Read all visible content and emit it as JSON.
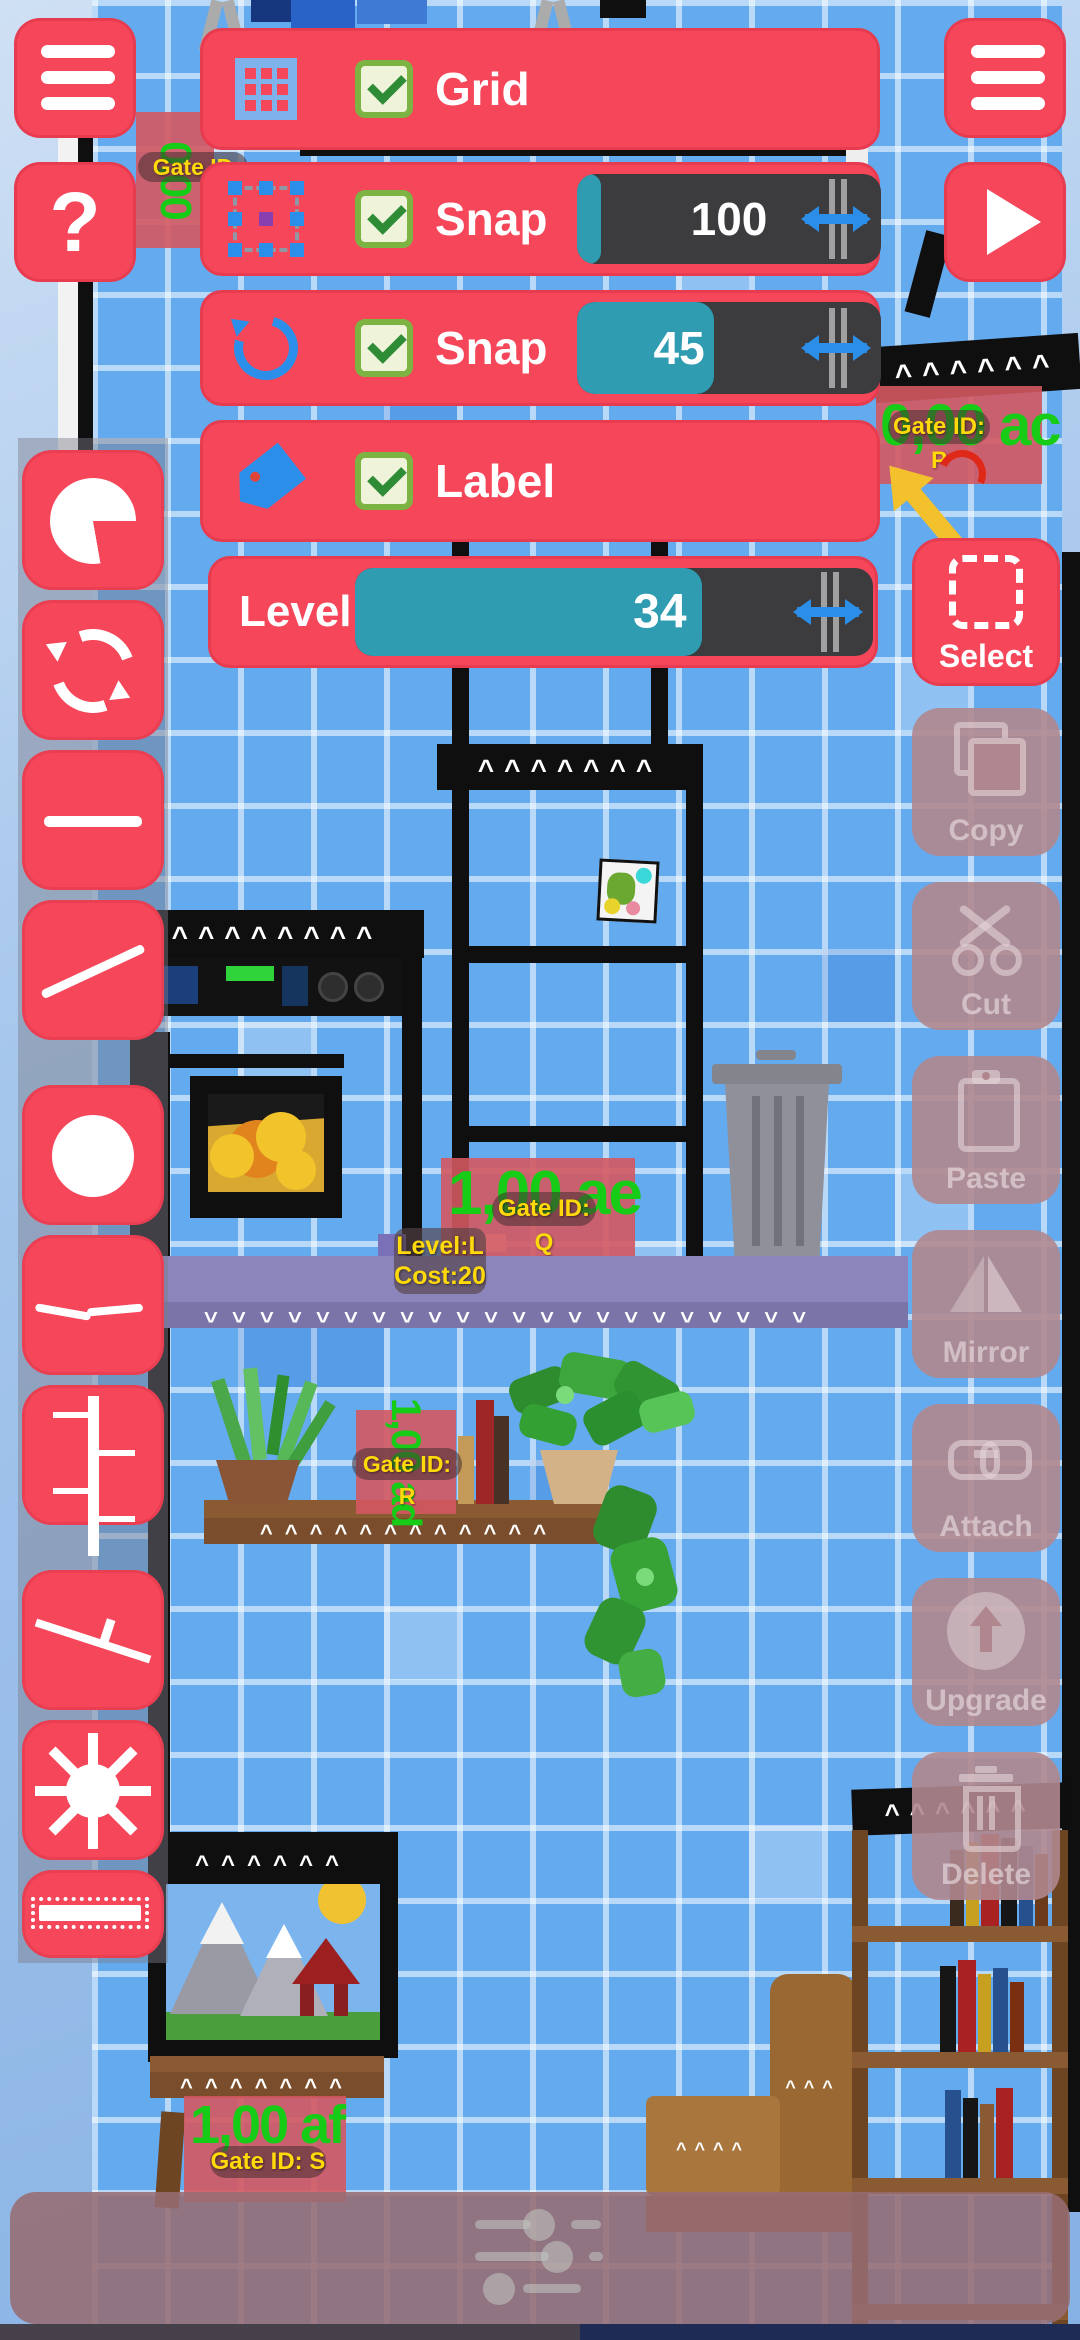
{
  "top_bar": {
    "help_label": "?",
    "menu_left_icon": "hamburger-icon",
    "menu_right_icon": "hamburger-icon",
    "play_icon": "play-icon"
  },
  "settings": {
    "grid": {
      "label": "Grid",
      "checked": true,
      "icon": "grid-icon"
    },
    "snap_move": {
      "label": "Snap",
      "checked": true,
      "value": "100",
      "fill_pct": 8,
      "icon": "selection-handles-icon"
    },
    "snap_rotate": {
      "label": "Snap",
      "checked": true,
      "value": "45",
      "fill_pct": 45,
      "icon": "rotate-icon"
    },
    "label_row": {
      "label": "Label",
      "checked": true,
      "icon": "tag-icon"
    },
    "level": {
      "label": "Level",
      "value": "34",
      "fill_pct": 67
    }
  },
  "tools_right": {
    "select": {
      "label": "Select",
      "enabled": true,
      "icon": "dashed-selection-icon"
    },
    "copy": {
      "label": "Copy",
      "enabled": false,
      "icon": "copy-icon"
    },
    "cut": {
      "label": "Cut",
      "enabled": false,
      "icon": "scissors-icon"
    },
    "paste": {
      "label": "Paste",
      "enabled": false,
      "icon": "clipboard-icon"
    },
    "mirror": {
      "label": "Mirror",
      "enabled": false,
      "icon": "mirror-triangles-icon"
    },
    "attach": {
      "label": "Attach",
      "enabled": false,
      "icon": "chain-link-icon"
    },
    "upgrade": {
      "label": "Upgrade",
      "enabled": false,
      "icon": "up-arrow-circle-icon"
    },
    "delete": {
      "label": "Delete",
      "enabled": false,
      "icon": "trash-icon"
    }
  },
  "tools_left": {
    "icons": [
      "pie-shape-icon",
      "cycle-arrows-icon",
      "horizontal-line-icon",
      "diagonal-line-icon",
      "circle-shape-icon",
      "shallow-angle-icon",
      "ruler-line-icon",
      "ramp-line-icon",
      "sun-icon",
      "conveyor-icon"
    ]
  },
  "scene": {
    "gates": {
      "p": {
        "id_label": "Gate ID: P",
        "value": "0,00 ac"
      },
      "q": {
        "id_label": "Gate ID: Q",
        "value": "1,00 ae"
      },
      "r": {
        "id_label": "Gate ID: R",
        "value": "1,00 ad"
      },
      "s": {
        "id_label": "Gate ID: S",
        "value": "1,00 af"
      },
      "partial_top_left": {
        "id_label": "Gate ID",
        "value": "0,00"
      }
    },
    "selected_info": {
      "line1": "Level:L",
      "line2": "Cost:20"
    }
  },
  "colors": {
    "accent_red": "#f5465a",
    "slider_teal": "#2f9cb2",
    "slider_track": "#3c3c3e",
    "icon_blue": "#2b8fea",
    "money_green": "#17cc17",
    "label_yellow": "#ffd90a",
    "disabled_mauve": "#b0878e",
    "platform_purple": "#8b85bb",
    "wall_blue": "#64aaef",
    "checkbox_green": "#7cb342"
  }
}
